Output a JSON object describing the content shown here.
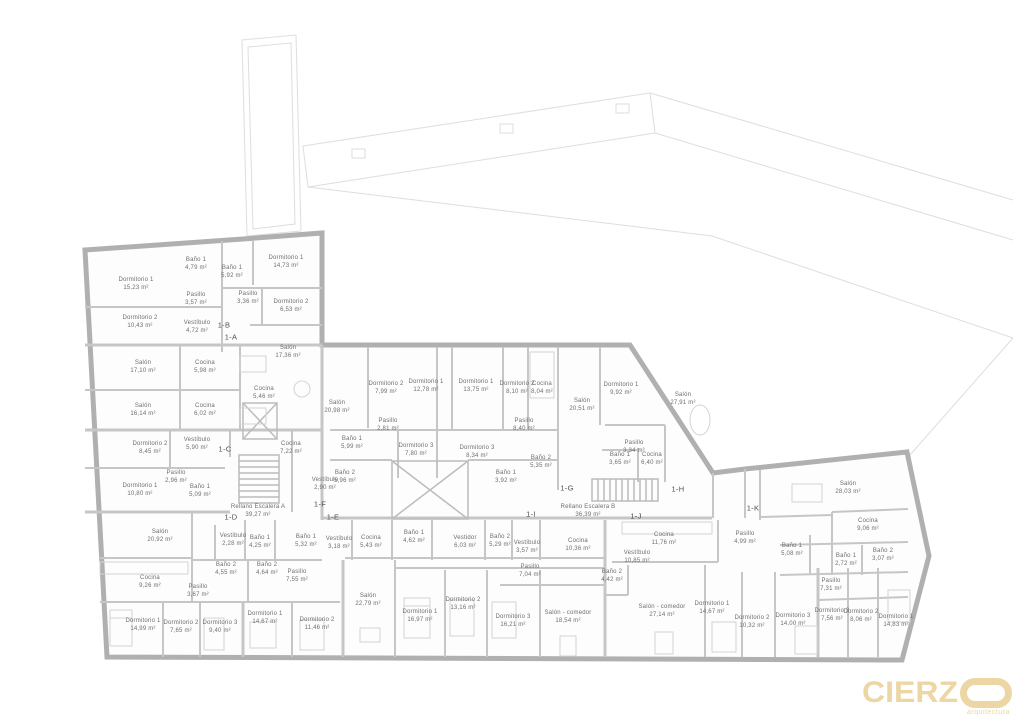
{
  "logo": {
    "brand_prefix": "CIERZ",
    "o_mark": "O",
    "tagline": "arquitectura",
    "color": "#ecd7a4"
  },
  "colors": {
    "exterior_wall": "#b0b0b0",
    "partition": "#c6c6c6",
    "site_line": "#dedede",
    "label_text": "#6e6e6e"
  },
  "units": [
    {
      "code": "1-B",
      "x": 224,
      "y": 325
    },
    {
      "code": "1-A",
      "x": 231,
      "y": 337
    },
    {
      "code": "1-C",
      "x": 225,
      "y": 449
    },
    {
      "code": "1-D",
      "x": 231,
      "y": 517
    },
    {
      "code": "1-E",
      "x": 333,
      "y": 517
    },
    {
      "code": "1-F",
      "x": 320,
      "y": 504
    },
    {
      "code": "1-G",
      "x": 567,
      "y": 488
    },
    {
      "code": "1-H",
      "x": 678,
      "y": 489
    },
    {
      "code": "1-I",
      "x": 531,
      "y": 514
    },
    {
      "code": "1-J",
      "x": 636,
      "y": 516
    },
    {
      "code": "1-K",
      "x": 753,
      "y": 508
    }
  ],
  "rooms": [
    {
      "name": "Baño 1",
      "area": "4,79 m²",
      "x": 196,
      "y": 264
    },
    {
      "name": "Dormitorio 1",
      "area": "15,23 m²",
      "x": 136,
      "y": 284
    },
    {
      "name": "Dormitorio 1",
      "area": "14,73 m²",
      "x": 286,
      "y": 262
    },
    {
      "name": "Baño 1",
      "area": "5,92 m²",
      "x": 232,
      "y": 272
    },
    {
      "name": "Pasillo",
      "area": "3,57 m²",
      "x": 196,
      "y": 299
    },
    {
      "name": "Pasillo",
      "area": "3,36 m²",
      "x": 248,
      "y": 298
    },
    {
      "name": "Dormitorio 2",
      "area": "6,53 m²",
      "x": 291,
      "y": 306
    },
    {
      "name": "Dormitorio 2",
      "area": "10,43 m²",
      "x": 140,
      "y": 322
    },
    {
      "name": "Vestíbulo",
      "area": "4,72 m²",
      "x": 197,
      "y": 327
    },
    {
      "name": "Salón",
      "area": "17,36 m²",
      "x": 288,
      "y": 352
    },
    {
      "name": "Salón",
      "area": "17,10 m²",
      "x": 143,
      "y": 367
    },
    {
      "name": "Cocina",
      "area": "5,98 m²",
      "x": 205,
      "y": 367
    },
    {
      "name": "Cocina",
      "area": "5,46 m²",
      "x": 264,
      "y": 393
    },
    {
      "name": "Salón",
      "area": "20,98 m²",
      "x": 337,
      "y": 407
    },
    {
      "name": "Salón",
      "area": "16,14 m²",
      "x": 143,
      "y": 410
    },
    {
      "name": "Cocina",
      "area": "6,02 m²",
      "x": 205,
      "y": 410
    },
    {
      "name": "Dormitorio 2",
      "area": "8,45 m²",
      "x": 150,
      "y": 448
    },
    {
      "name": "Vestíbulo",
      "area": "5,90 m²",
      "x": 197,
      "y": 444
    },
    {
      "name": "Cocina",
      "area": "7,22 m²",
      "x": 291,
      "y": 448
    },
    {
      "name": "Pasillo",
      "area": "2,96 m²",
      "x": 176,
      "y": 477
    },
    {
      "name": "Dormitorio 1",
      "area": "10,80 m²",
      "x": 140,
      "y": 490
    },
    {
      "name": "Baño 1",
      "area": "5,09 m²",
      "x": 200,
      "y": 491
    },
    {
      "name": "Vestíbulo",
      "area": "2,90 m²",
      "x": 325,
      "y": 484
    },
    {
      "name": "Dormitorio 2",
      "area": "7,99 m²",
      "x": 386,
      "y": 388
    },
    {
      "name": "Dormitorio 1",
      "area": "12,78 m²",
      "x": 426,
      "y": 386
    },
    {
      "name": "Dormitorio 1",
      "area": "13,75 m²",
      "x": 476,
      "y": 386
    },
    {
      "name": "Dormitorio 2",
      "area": "8,10 m²",
      "x": 517,
      "y": 388
    },
    {
      "name": "Cocina",
      "area": "8,04 m²",
      "x": 542,
      "y": 388
    },
    {
      "name": "Salón",
      "area": "20,51 m²",
      "x": 582,
      "y": 405
    },
    {
      "name": "Dormitorio 1",
      "area": "9,92 m²",
      "x": 621,
      "y": 389
    },
    {
      "name": "Salón",
      "area": "27,91 m²",
      "x": 683,
      "y": 399
    },
    {
      "name": "Pasillo",
      "area": "2,81 m²",
      "x": 388,
      "y": 425
    },
    {
      "name": "Pasillo",
      "area": "8,40 m²",
      "x": 524,
      "y": 425
    },
    {
      "name": "Baño 1",
      "area": "5,99 m²",
      "x": 352,
      "y": 443
    },
    {
      "name": "Dormitorio 3",
      "area": "7,80 m²",
      "x": 416,
      "y": 450
    },
    {
      "name": "Dormitorio 3",
      "area": "8,34 m²",
      "x": 477,
      "y": 452
    },
    {
      "name": "Pasillo",
      "area": "3,34 m²",
      "x": 634,
      "y": 447
    },
    {
      "name": "Baño 2",
      "area": "5,96 m²",
      "x": 345,
      "y": 477
    },
    {
      "name": "Baño 2",
      "area": "5,35 m²",
      "x": 541,
      "y": 462
    },
    {
      "name": "Baño 1",
      "area": "3,92 m²",
      "x": 506,
      "y": 477
    },
    {
      "name": "Baño 1",
      "area": "3,65 m²",
      "x": 620,
      "y": 459
    },
    {
      "name": "Cocina",
      "area": "6,40 m²",
      "x": 652,
      "y": 459
    },
    {
      "name": "Rellano Escalera A",
      "area": "39,27 m²",
      "x": 258,
      "y": 511
    },
    {
      "name": "Rellano Escalera B",
      "area": "36,39 m²",
      "x": 588,
      "y": 511
    },
    {
      "name": "Salón",
      "area": "20,92 m²",
      "x": 160,
      "y": 536
    },
    {
      "name": "Vestíbulo",
      "area": "2,28 m²",
      "x": 233,
      "y": 540
    },
    {
      "name": "Baño 1",
      "area": "4,25 m²",
      "x": 260,
      "y": 542
    },
    {
      "name": "Baño 2",
      "area": "4,55 m²",
      "x": 226,
      "y": 569
    },
    {
      "name": "Cocina",
      "area": "9,26 m²",
      "x": 150,
      "y": 582
    },
    {
      "name": "Pasillo",
      "area": "3,67 m²",
      "x": 198,
      "y": 591
    },
    {
      "name": "Dormitorio 1",
      "area": "14,99 m²",
      "x": 143,
      "y": 625
    },
    {
      "name": "Dormitorio 2",
      "area": "7,65 m²",
      "x": 181,
      "y": 627
    },
    {
      "name": "Dormitorio 3",
      "area": "9,40 m²",
      "x": 220,
      "y": 627
    },
    {
      "name": "Baño 1",
      "area": "5,32 m²",
      "x": 306,
      "y": 541
    },
    {
      "name": "Vestíbulo",
      "area": "3,18 m²",
      "x": 339,
      "y": 543
    },
    {
      "name": "Baño 2",
      "area": "4,64 m²",
      "x": 267,
      "y": 569
    },
    {
      "name": "Pasillo",
      "area": "7,55 m²",
      "x": 297,
      "y": 576
    },
    {
      "name": "Dormitorio 1",
      "area": "14,67 m²",
      "x": 265,
      "y": 618
    },
    {
      "name": "Dormitorio 2",
      "area": "11,46 m²",
      "x": 317,
      "y": 624
    },
    {
      "name": "Salón",
      "area": "22,79 m²",
      "x": 368,
      "y": 600
    },
    {
      "name": "Cocina",
      "area": "5,43 m²",
      "x": 371,
      "y": 542
    },
    {
      "name": "Baño 1",
      "area": "4,62 m²",
      "x": 414,
      "y": 537
    },
    {
      "name": "Vestidor",
      "area": "6,03 m²",
      "x": 465,
      "y": 542
    },
    {
      "name": "Baño 2",
      "area": "5,29 m²",
      "x": 500,
      "y": 541
    },
    {
      "name": "Vestíbulo",
      "area": "3,57 m²",
      "x": 527,
      "y": 547
    },
    {
      "name": "Pasillo",
      "area": "7,04 m²",
      "x": 530,
      "y": 571
    },
    {
      "name": "Cocina",
      "area": "10,36 m²",
      "x": 578,
      "y": 545
    },
    {
      "name": "Dormitorio 1",
      "area": "16,97 m²",
      "x": 420,
      "y": 616
    },
    {
      "name": "Dormitorio 2",
      "area": "13,16 m²",
      "x": 463,
      "y": 604
    },
    {
      "name": "Dormitorio 3",
      "area": "16,21 m²",
      "x": 513,
      "y": 621
    },
    {
      "name": "Salón - comedor",
      "area": "18,54 m²",
      "x": 568,
      "y": 617
    },
    {
      "name": "Cocina",
      "area": "11,76 m²",
      "x": 664,
      "y": 539
    },
    {
      "name": "Vestíbulo",
      "area": "10,85 m²",
      "x": 637,
      "y": 557
    },
    {
      "name": "Baño 2",
      "area": "4,42 m²",
      "x": 612,
      "y": 576
    },
    {
      "name": "Pasillo",
      "area": "4,99 m²",
      "x": 745,
      "y": 538
    },
    {
      "name": "Salón - comedor",
      "area": "27,14 m²",
      "x": 662,
      "y": 611
    },
    {
      "name": "Dormitorio 1",
      "area": "14,67 m²",
      "x": 712,
      "y": 608
    },
    {
      "name": "Dormitorio 2",
      "area": "10,32 m²",
      "x": 752,
      "y": 622
    },
    {
      "name": "Dormitorio 3",
      "area": "14,00 m²",
      "x": 793,
      "y": 620
    },
    {
      "name": "Baño 1",
      "area": "5,08 m²",
      "x": 792,
      "y": 550
    },
    {
      "name": "Salón",
      "area": "28,03 m²",
      "x": 848,
      "y": 488
    },
    {
      "name": "Cocina",
      "area": "9,06 m²",
      "x": 868,
      "y": 525
    },
    {
      "name": "Baño 1",
      "area": "2,72 m²",
      "x": 846,
      "y": 560
    },
    {
      "name": "Baño 2",
      "area": "3,07 m²",
      "x": 883,
      "y": 555
    },
    {
      "name": "Pasillo",
      "area": "7,31 m²",
      "x": 831,
      "y": 585
    },
    {
      "name": "Dormitorio 3",
      "area": "7,56 m²",
      "x": 832,
      "y": 615
    },
    {
      "name": "Dormitorio 2",
      "area": "8,06 m²",
      "x": 861,
      "y": 616
    },
    {
      "name": "Dormitorio 1",
      "area": "14,83 m²",
      "x": 896,
      "y": 621
    }
  ]
}
